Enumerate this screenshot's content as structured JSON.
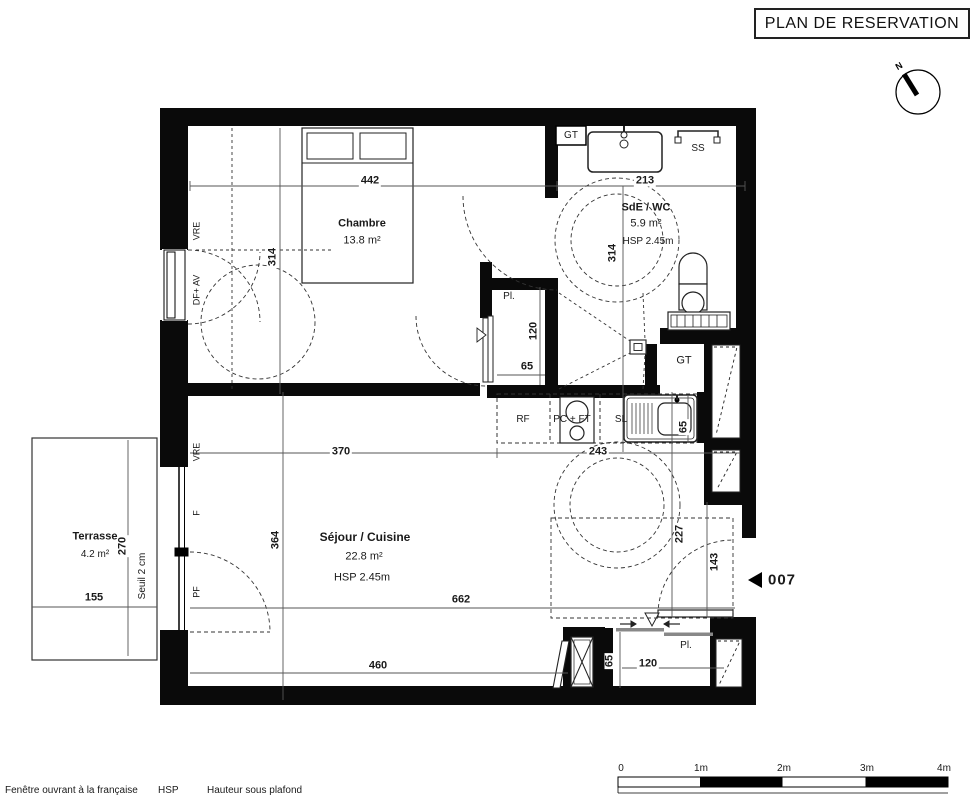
{
  "header": {
    "title": "PLAN DE RESERVATION"
  },
  "compass": {
    "north": "N"
  },
  "unit": {
    "marker": "007"
  },
  "rooms": {
    "chambre": {
      "name": "Chambre",
      "area": "13.8 m²"
    },
    "sde": {
      "name": "SdE / WC",
      "area": "5.9 m²",
      "hsp": "HSP 2.45m"
    },
    "sejour": {
      "name": "Séjour / Cuisine",
      "area": "22.8 m²",
      "hsp": "HSP 2.45m"
    },
    "terrasse": {
      "name": "Terrasse",
      "area": "4.2 m²"
    }
  },
  "labels": {
    "gt_top": "GT",
    "gt_shaft": "GT",
    "towel_rail": "SS",
    "fridge": "RF",
    "hob_oven": "PC + FT",
    "washer": "SL",
    "closet_hall": "Pl.",
    "closet_entry": "Pl."
  },
  "openings": {
    "vre_chambre": "VRE",
    "df_av": "DF+ AV",
    "vre_sejour": "VRE",
    "f": "F",
    "pf": "PF",
    "seuil": "Seuil 2 cm"
  },
  "dimensions": {
    "chambre_w": "442",
    "sde_w": "213",
    "chambre_h": "314",
    "sde_h": "314",
    "closet_h": "120",
    "closet_w": "65",
    "sejour_w1": "370",
    "kitchen_w": "243",
    "sejour_h": "364",
    "terrasse_h": "270",
    "terrasse_w": "155",
    "sejour_w2": "662",
    "sejour_w3": "460",
    "hall_h": "227",
    "entry_w": "143",
    "sink_d": "65",
    "closet2_d": "65",
    "closet2_w": "120"
  },
  "legend": {
    "window_label": "Fenêtre ouvrant à la française",
    "hsp_abbr": "HSP",
    "hsp_label": "Hauteur sous plafond"
  },
  "scale": {
    "t0": "0",
    "t1": "1m",
    "t2": "2m",
    "t3": "3m",
    "t4": "4m"
  }
}
